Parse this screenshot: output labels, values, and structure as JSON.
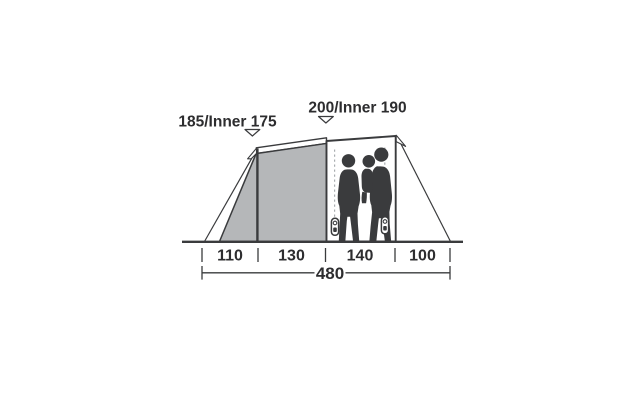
{
  "diagram": {
    "subject": "tent-side-profile-with-dimensions",
    "height_labels": {
      "left": "185/Inner 175",
      "right": "200/Inner 190"
    },
    "ground_segments": [
      "110",
      "130",
      "140",
      "100"
    ],
    "total_length": "480",
    "icons": {
      "left_pointer": "chevron-down-arrow",
      "right_pointer": "chevron-down-arrow"
    },
    "colors": {
      "fabric_gray": "#b5b7b9",
      "outline_dark": "#3a3b3d",
      "silhouette": "#3a3b3d",
      "dashed_zip": "#a9adb0",
      "text": "#2d2d2f",
      "background": "#ffffff"
    }
  }
}
